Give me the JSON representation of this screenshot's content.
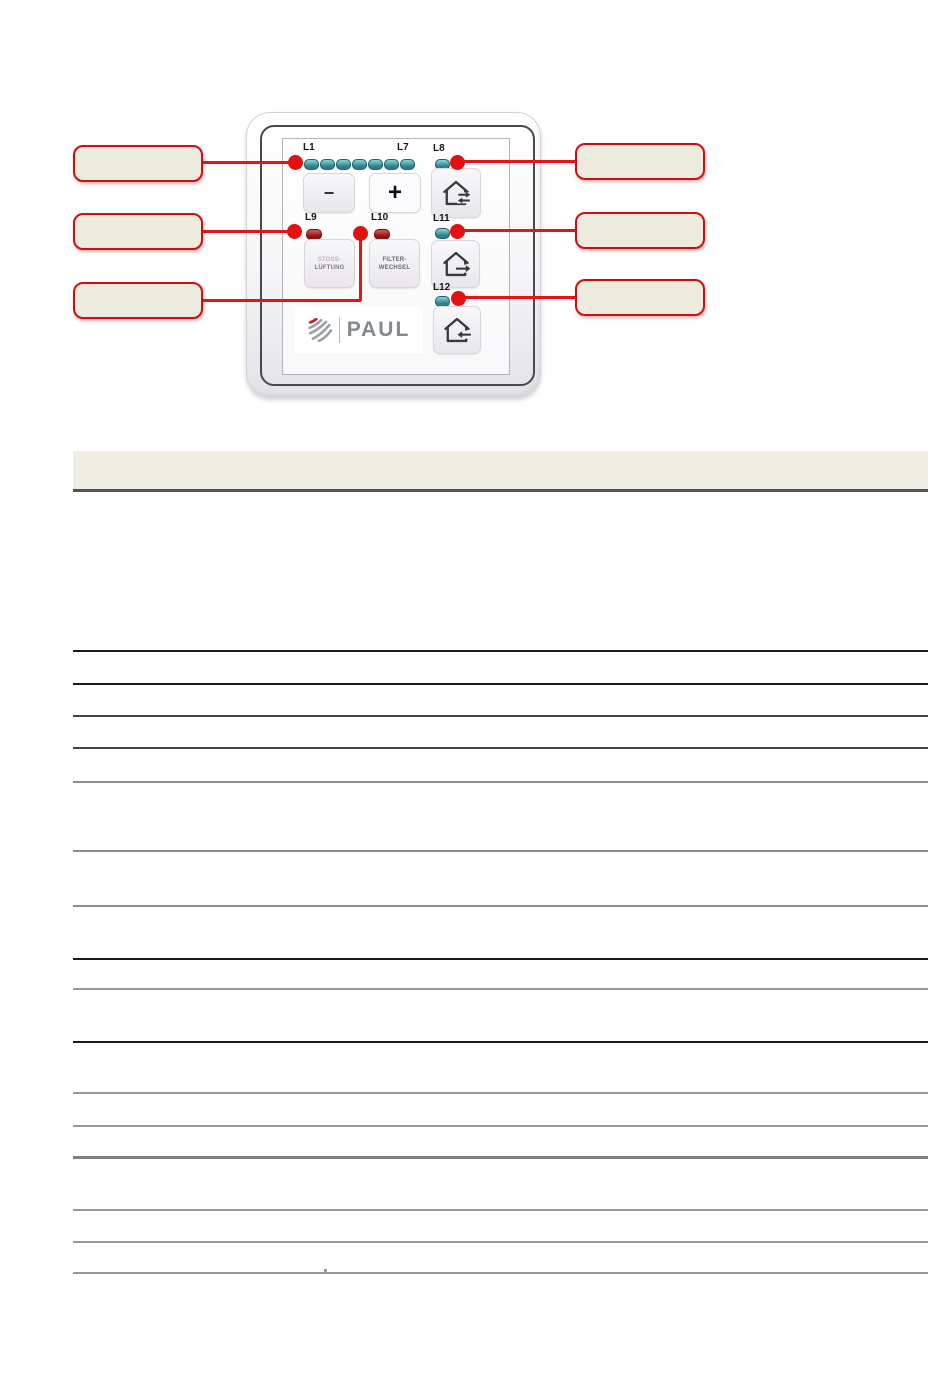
{
  "document": {
    "type": "manual-page-with-device-figure-and-empty-table",
    "table_header_text": "",
    "table_cells_text": []
  },
  "device_panel": {
    "brand_logo_text": "PAUL",
    "led_scale": {
      "first_label": "L1",
      "last_label": "L7",
      "led_count": 7
    },
    "labels": {
      "l8": "L8",
      "l9": "L9",
      "l10": "L10",
      "l11": "L11",
      "l12": "L12"
    },
    "buttons": {
      "minus": "−",
      "plus": "+",
      "stoss_line1": "STOSS-",
      "stoss_line2": "LÜFTUNG",
      "filter_line1": "FILTER-",
      "filter_line2": "WECHSEL"
    },
    "icons": {
      "house_exchange": "house with two opposing arrows (air exchange)",
      "house_arrow_out": "house with arrow pointing right",
      "house_arrow_in": "house with arrow pointing left"
    }
  },
  "callouts": {
    "left": [
      {
        "text": ""
      },
      {
        "text": ""
      },
      {
        "text": ""
      }
    ],
    "right": [
      {
        "text": ""
      },
      {
        "text": ""
      },
      {
        "text": ""
      }
    ]
  },
  "colors": {
    "callout_border_red": "#cf0f0f",
    "callout_fill_beige": "#edeade",
    "connector_red": "#e31515",
    "table_header_beige": "#f0ede3",
    "table_header_border": "#56554d",
    "led_teal": "#2f808b",
    "led_red": "#8d1414",
    "logo_gray": "#84898e"
  }
}
